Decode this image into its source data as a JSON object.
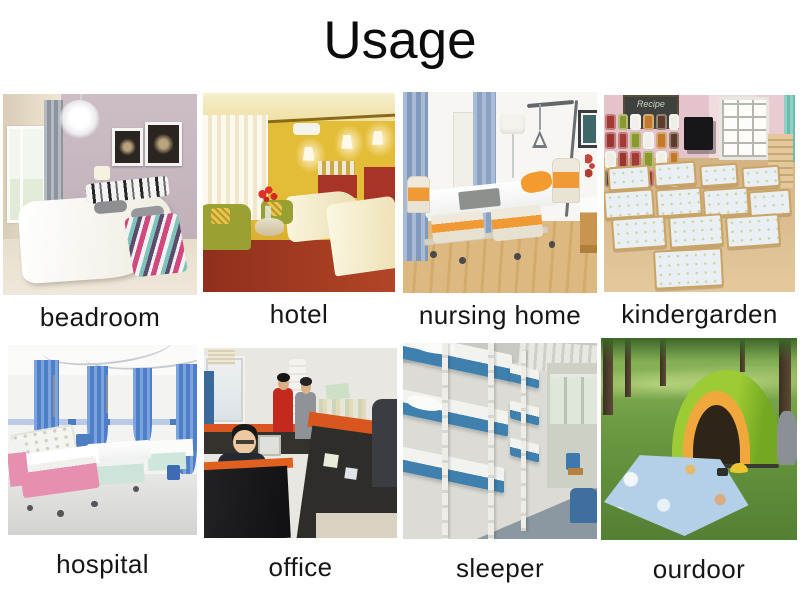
{
  "title": "Usage",
  "colors": {
    "page_background": "#ffffff",
    "title_color": "#0c0c0c",
    "caption_color": "#161616"
  },
  "grid": {
    "items": [
      {
        "caption": "beadroom",
        "scene": "bedroom"
      },
      {
        "caption": "hotel",
        "scene": "hotel"
      },
      {
        "caption": "nursing home",
        "scene": "nursing-home"
      },
      {
        "caption": "kindergarden",
        "scene": "kindergarten",
        "board_text": "Recipe"
      },
      {
        "caption": "hospital",
        "scene": "hospital"
      },
      {
        "caption": "office",
        "scene": "office"
      },
      {
        "caption": "sleeper",
        "scene": "sleeper-train"
      },
      {
        "caption": "ourdoor",
        "scene": "outdoor-camping"
      }
    ]
  }
}
